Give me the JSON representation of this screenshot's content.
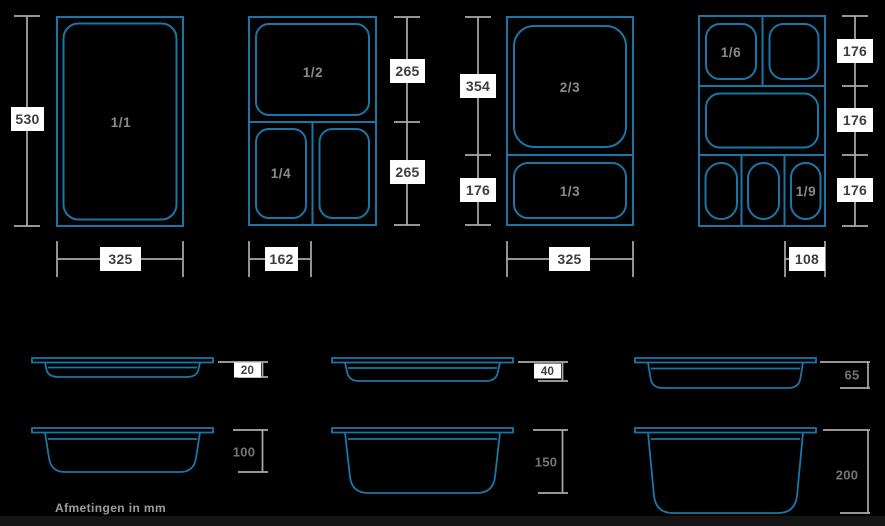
{
  "footnote": "Afmetingen in mm",
  "colors": {
    "background": "#000000",
    "outline_blue": "#1B76A8",
    "dim_line_gray": "#ABABAB",
    "dim_box_bg": "#FFFFFF",
    "dim_box_text": "#3D3D3D",
    "cell_label_gray": "#8A8A8A",
    "depth_label_gray": "#757575",
    "footer_bar": "#141414"
  },
  "top_views": [
    {
      "cell_labels": [
        "1/1"
      ],
      "height_labels": [
        "530"
      ],
      "width_label": "325"
    },
    {
      "cell_labels": [
        "1/2",
        "1/4"
      ],
      "height_labels": [
        "265",
        "265"
      ],
      "width_label": "162"
    },
    {
      "cell_labels": [
        "2/3",
        "1/3"
      ],
      "height_labels": [
        "354",
        "176"
      ],
      "width_label": "325"
    },
    {
      "cell_labels": [
        "1/6",
        "1/9"
      ],
      "height_labels": [
        "176",
        "176",
        "176"
      ],
      "width_label": "108"
    }
  ],
  "side_views": [
    {
      "depth_label": "20"
    },
    {
      "depth_label": "40"
    },
    {
      "depth_label": "65"
    },
    {
      "depth_label": "100"
    },
    {
      "depth_label": "150"
    },
    {
      "depth_label": "200"
    }
  ]
}
